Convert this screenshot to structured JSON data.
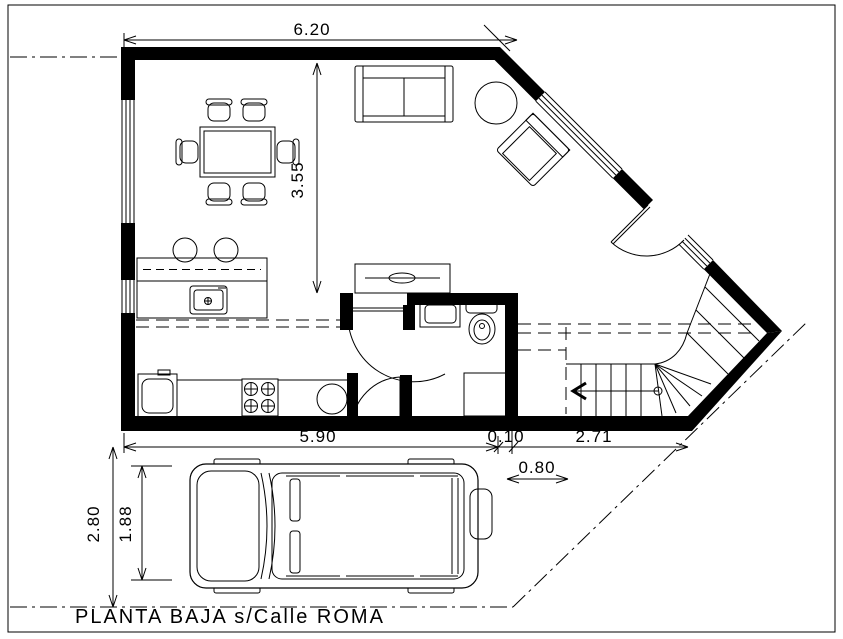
{
  "drawing": {
    "title": "PLANTA BAJA  s/Calle ROMA"
  },
  "dimensions": {
    "top_width": "6.20",
    "living_depth": "3.55",
    "bottom_main": "5.90",
    "wall_offset": "0.10",
    "stair_bay": "2.71",
    "path_width": "0.80",
    "driveway_depth": "2.80",
    "car_width": "1.88"
  },
  "colors": {
    "ink": "#000000",
    "paper": "#ffffff"
  }
}
